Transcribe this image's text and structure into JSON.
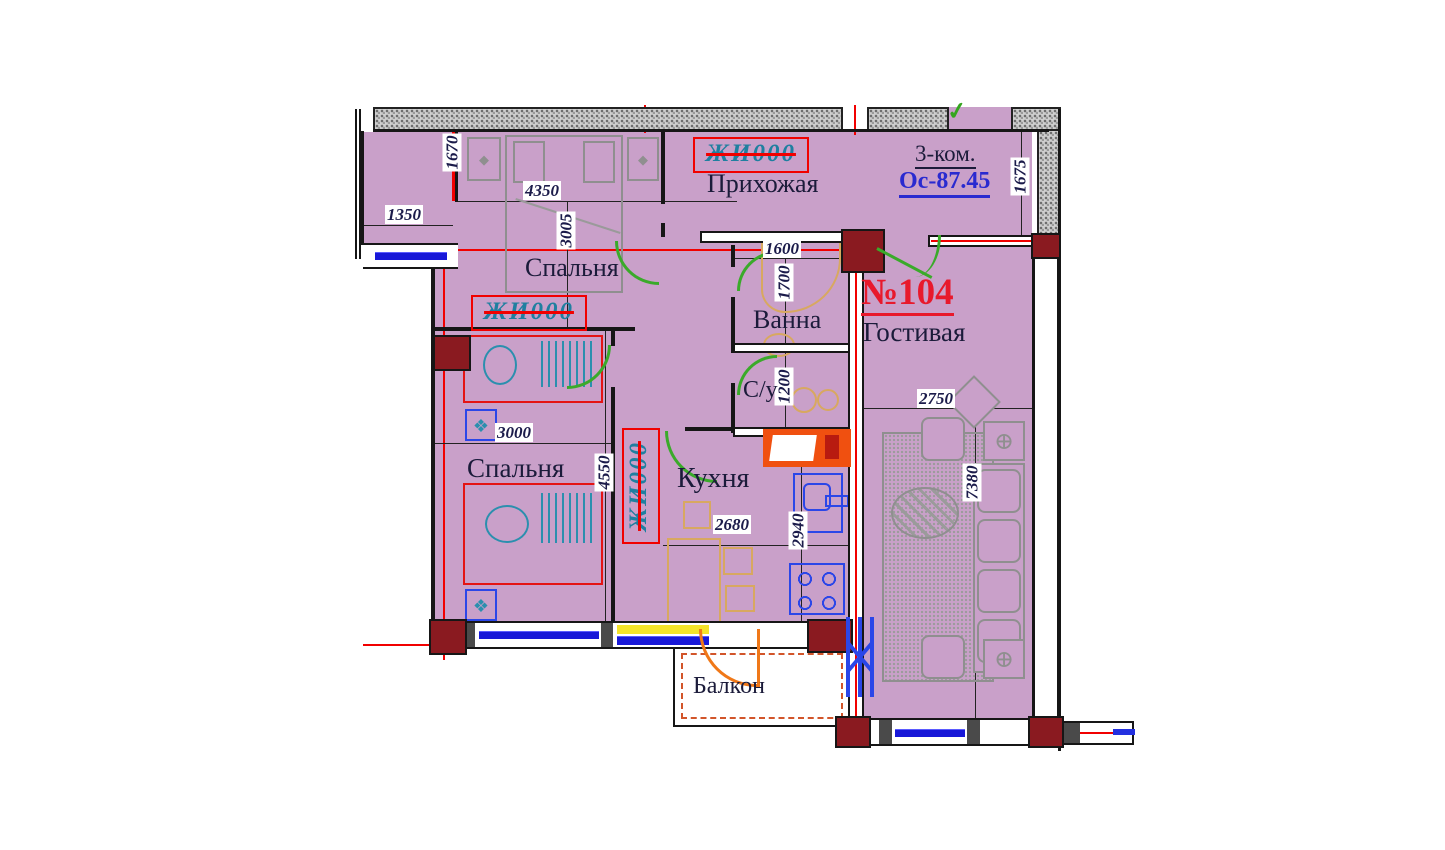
{
  "apartment": {
    "number": "№104",
    "rooms_count_label": "3-ком.",
    "area_label": "Ос-87.45"
  },
  "rooms": {
    "hallway": "Прихожая",
    "bedroom1": "Спальня",
    "bedroom2": "Спальня",
    "bath": "Ванна",
    "wc": "С/у",
    "kitchen": "Кухня",
    "living": "Гостивая",
    "balcony": "Балкон"
  },
  "stamp": {
    "text": "ЖИ000"
  },
  "dims": {
    "d1670": "1670",
    "d4350": "4350",
    "d1350": "1350",
    "d3005": "3005",
    "d1600": "1600",
    "d1700": "1700",
    "d1675": "1675",
    "d1200": "1200",
    "d3000": "3000",
    "d4550": "4550",
    "d2680": "2680",
    "d2940": "2940",
    "d2750": "2750",
    "d7380": "7380"
  },
  "colors": {
    "room_fill": "#c9a0c9",
    "wall_block": "#8a1a20",
    "axis_red": "#f10000",
    "stamp_teal": "#1f7fa0",
    "apt_number_red": "#e8192c",
    "area_blue": "#2a2ad0",
    "door_green": "#3aaa2a",
    "balcony_orange": "#f07818",
    "fixture_blue": "#2b46e8",
    "furniture_tan": "#d8a860",
    "furniture_gray": "#8f8f8f",
    "label_ink": "#1b1b3a"
  }
}
